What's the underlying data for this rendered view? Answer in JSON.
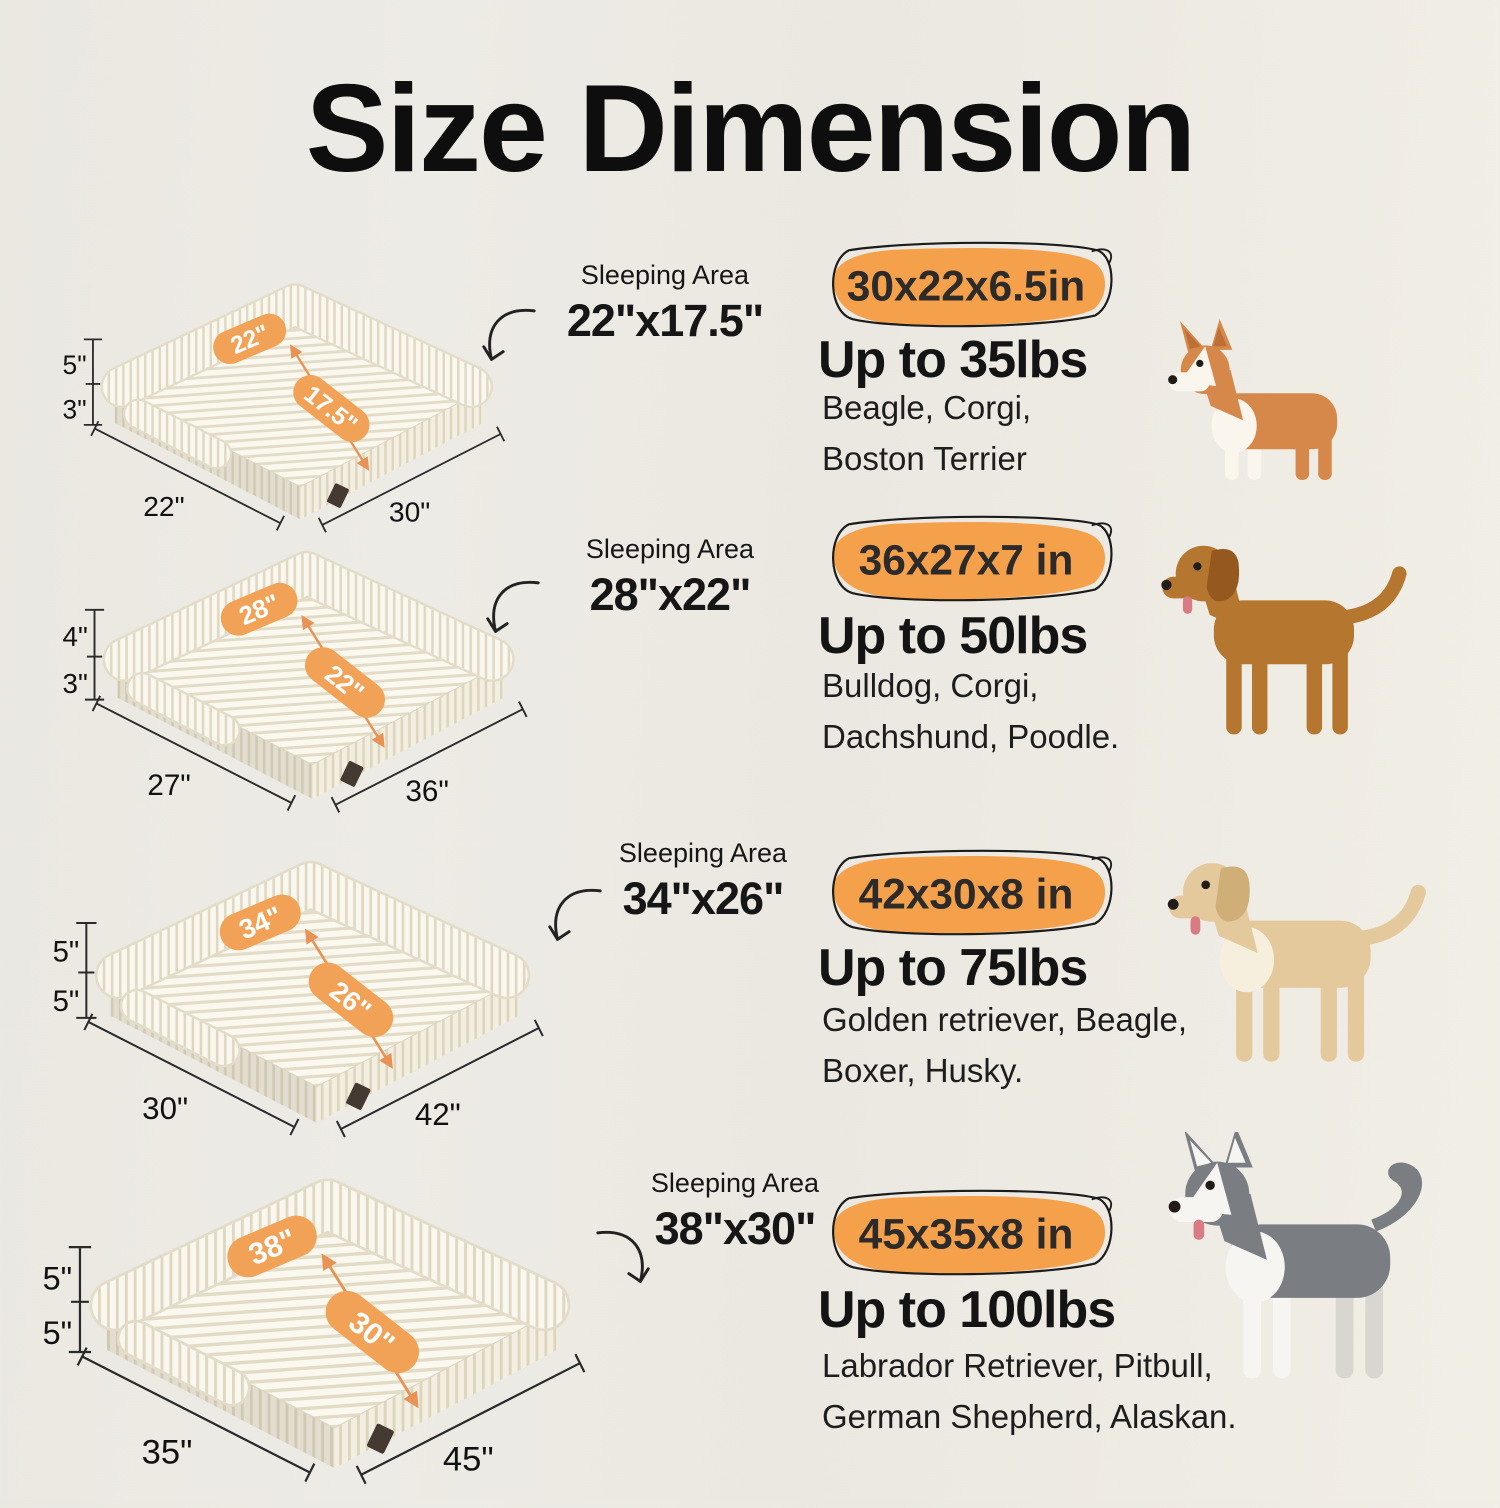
{
  "page": {
    "title": "Size Dimension",
    "background": "#edebe5"
  },
  "accent": {
    "badge_orange": "#f5a14c",
    "pill_orange": "#f2a256",
    "measure_arrow_orange": "#e89255",
    "outline_ink": "#1c1c1c"
  },
  "rows": [
    {
      "bed": {
        "h1": "3.5\"",
        "h2": "3\"",
        "depth": "22\"",
        "width": "30\"",
        "top_label": "22\"",
        "mid_label": "17.5\""
      },
      "sleeping": {
        "label": "Sleeping Area",
        "value": "22\"x17.5\""
      },
      "badge": "30x22x6.5in",
      "weight": "Up to 35lbs",
      "breeds": [
        "Beagle, Corgi,",
        "Boston Terrier"
      ],
      "dog": {
        "name": "corgi",
        "icon": "corgi-dog-photo",
        "coat": "#d6884a",
        "belly": "#faf6ee",
        "ears": "pointy",
        "ear_color": "#bc7036",
        "build": "short",
        "tail": "none",
        "blaze": true,
        "leg_front": "#faf6ee",
        "tongue": false
      }
    },
    {
      "bed": {
        "h1": "4\"",
        "h2": "3\"",
        "depth": "27\"",
        "width": "36\"",
        "top_label": "28\"",
        "mid_label": "22\""
      },
      "sleeping": {
        "label": "Sleeping Area",
        "value": "28\"x22\""
      },
      "badge": "36x27x7 in",
      "weight": "Up to 50lbs",
      "breeds": [
        "Bulldog, Corgi,",
        "Dachshund, Poodle."
      ],
      "dog": {
        "name": "golden-retriever",
        "icon": "golden-retriever-dog-photo",
        "coat": "#b5762f",
        "ears": "floppy",
        "ear_color": "#95591f",
        "build": "tall",
        "tail": "plume",
        "blaze": false,
        "tongue": true
      }
    },
    {
      "bed": {
        "h1": "4.5\"",
        "h2": "3.5\"",
        "depth": "30\"",
        "width": "42\"",
        "top_label": "34\"",
        "mid_label": "26\""
      },
      "sleeping": {
        "label": "Sleeping Area",
        "value": "34\"x26\""
      },
      "badge": "42x30x8 in",
      "weight": "Up to 75lbs",
      "breeds": [
        "Golden retriever, Beagle,",
        "Boxer, Husky."
      ],
      "dog": {
        "name": "labrador",
        "icon": "labrador-dog-photo",
        "coat": "#e4c99c",
        "belly": "#f7efdd",
        "ears": "floppy",
        "ear_color": "#d0ae77",
        "build": "tall",
        "tail": "plume",
        "blaze": false,
        "tongue": true
      }
    },
    {
      "bed": {
        "h1": "4.5\"",
        "h2": "3.5\"",
        "depth": "35\"",
        "width": "45\"",
        "top_label": "38\"",
        "mid_label": "30\""
      },
      "sleeping": {
        "label": "Sleeping Area",
        "value": "38\"x30\""
      },
      "badge": "45x35x8 in",
      "weight": "Up to 100lbs",
      "breeds": [
        "Labrador Retriever, Pitbull,",
        "German Shepherd, Alaskan."
      ],
      "dog": {
        "name": "husky",
        "icon": "husky-dog-photo",
        "coat": "#7a7e83",
        "belly": "#f6f5f2",
        "ears": "pointy",
        "ear_color": "#f6f5f2",
        "build": "tall",
        "tail": "curl",
        "blaze": true,
        "leg_front": "#f6f5f2",
        "leg_back": "#d9d6d0",
        "tongue": true
      }
    }
  ]
}
